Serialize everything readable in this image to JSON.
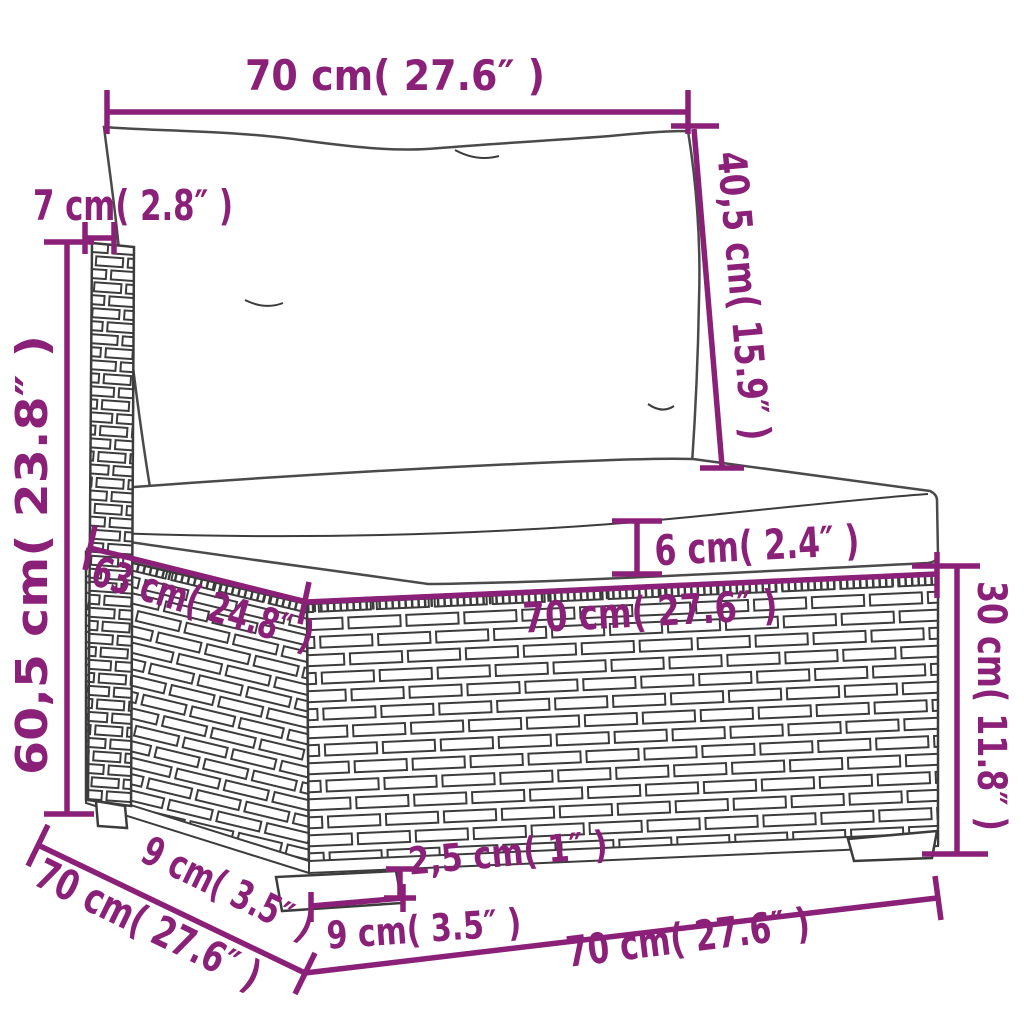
{
  "diagram": {
    "subject": "rattan-sofa-section-dimension-sketch",
    "colors": {
      "dimension_accent": "#8b2078",
      "line_art": "#3c3c3c",
      "background": "#ffffff"
    },
    "dim": {
      "top_width": "70 cm( 27.6″ )",
      "back_height": "40,5 cm( 15.9″ )",
      "armrest_width": "7 cm( 2.8″ )",
      "total_height": "60,5 cm( 23.8″ )",
      "cushion_thickness": "6 cm( 2.4″ )",
      "seat_depth": "63 cm( 24.8″ )",
      "seat_width": "70 cm( 27.6″ )",
      "base_height": "30 cm( 11.8″ )",
      "leg_height": "2,5 cm( 1″ )",
      "leg_width": "9 cm( 3.5″ )",
      "leg_depth": "9 cm( 3.5″ )",
      "bottom_depth": "70 cm( 27.6″ )",
      "bottom_width": "70 cm( 27.6″ )"
    }
  }
}
